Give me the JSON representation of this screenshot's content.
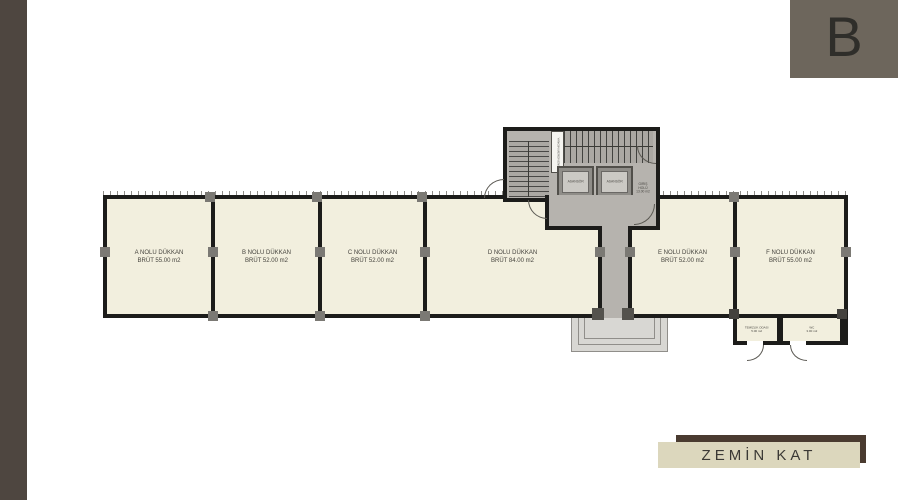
{
  "badge": {
    "letter": "B"
  },
  "floor": {
    "label": "ZEMİN KAT"
  },
  "plan": {
    "shops": [
      {
        "name": "A NOLU DÜKKAN",
        "area": "BRÜT 55.00 m2"
      },
      {
        "name": "B NOLU DÜKKAN",
        "area": "BRÜT 52.00 m2"
      },
      {
        "name": "C NOLU DÜKKAN",
        "area": "BRÜT 52.00 m2"
      },
      {
        "name": "D NOLU DÜKKAN",
        "area": "BRÜT 84.00 m2"
      },
      {
        "name": "E NOLU DÜKKAN",
        "area": "BRÜT 52.00 m2"
      },
      {
        "name": "F NOLU DÜKKAN",
        "area": "BRÜT 55.00 m2"
      }
    ],
    "core": {
      "elevator_1": "ASANSÖR",
      "elevator_2": "ASANSÖR",
      "fire_stair": "YANGIN MERDİVENİ",
      "hall_name": "GİRİŞ HOLÜ",
      "hall_area": "13.00 m2"
    },
    "service_rooms": [
      {
        "name": "TEMİZLİK ODASI",
        "area": "5.00 m2"
      },
      {
        "name": "WC",
        "area": "3.00 m2"
      }
    ]
  },
  "colors": {
    "band": "#4e4640",
    "badge": "#6d665c",
    "room_fill": "#f2efde",
    "wall": "#1c1c1a",
    "core_floor": "#b6b3ae",
    "plate_dark": "#4a3b30",
    "plate_light": "#dcd7bd"
  }
}
